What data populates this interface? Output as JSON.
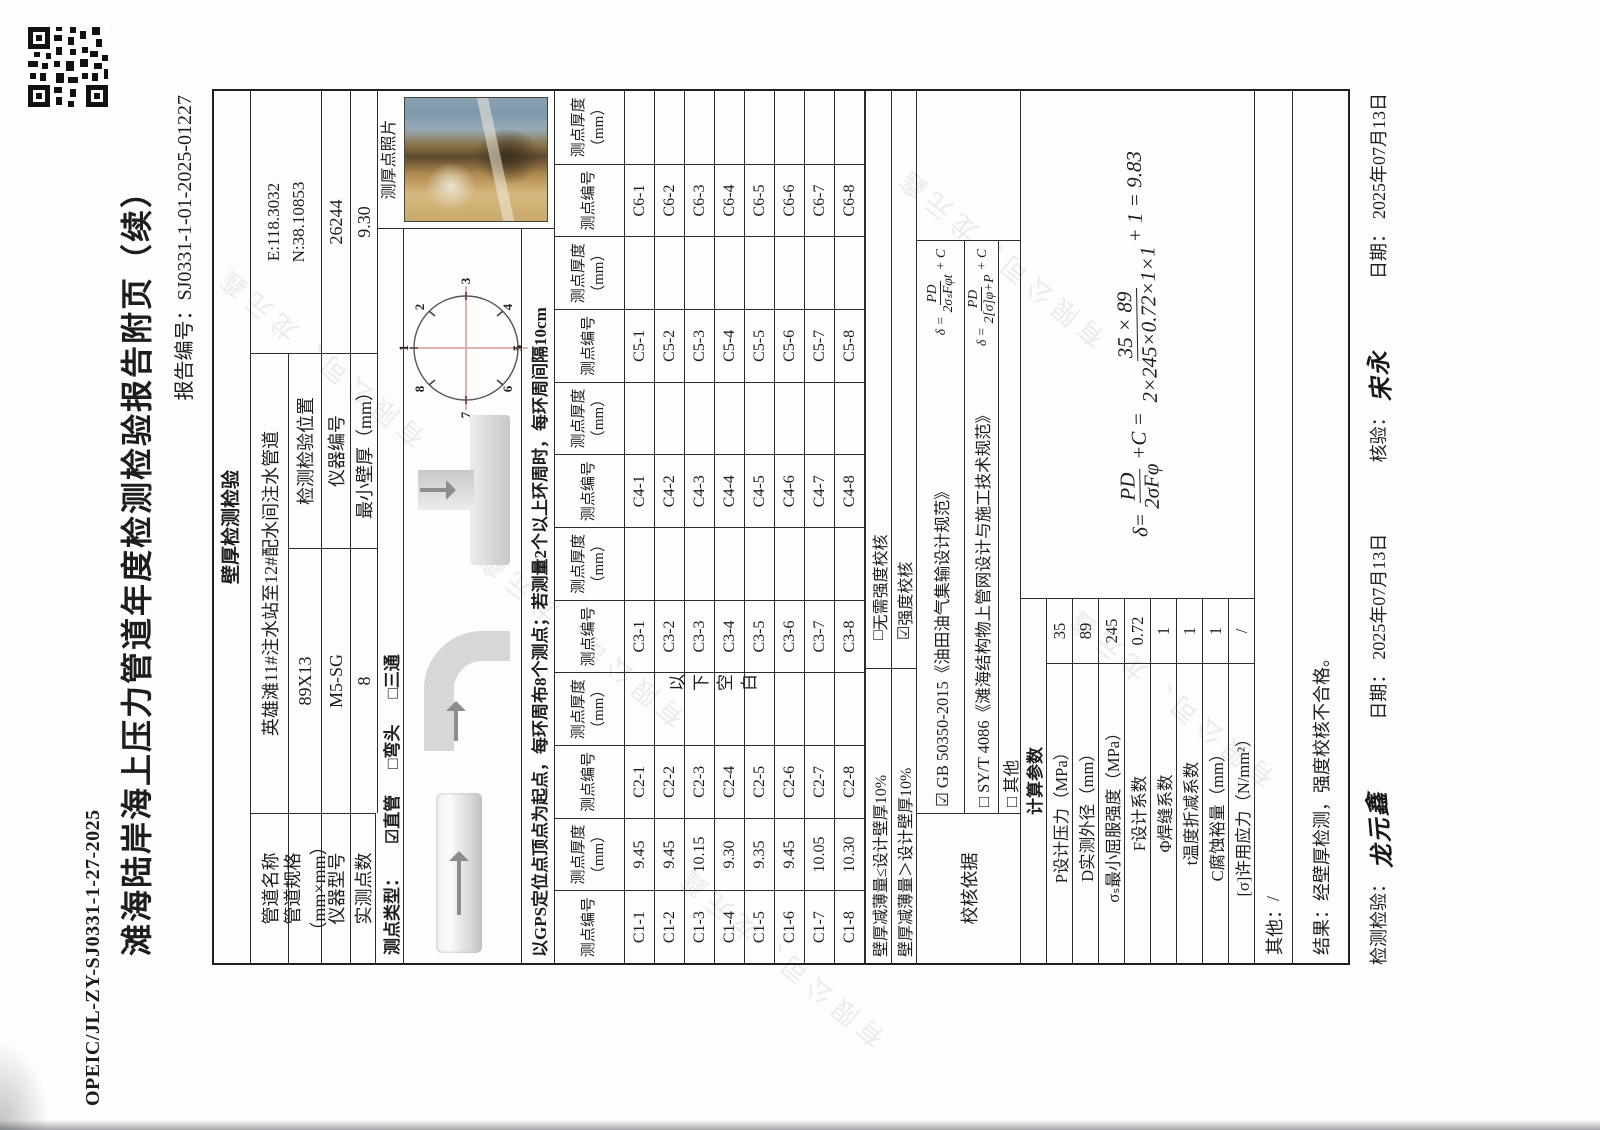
{
  "doc": {
    "code": "OPEIC/JL-ZY-SJ0331-1-27-2025",
    "title": "滩海陆岸海上压力管道年度检测检验报告附页（续）",
    "report_no_label": "报告编号：",
    "report_no": "SJ0331-1-01-2025-01227"
  },
  "section_title": "壁厚检测检验",
  "info": {
    "pipe_name_label": "管道名称",
    "pipe_name": "英雄滩11#注水站至12#配水间注水管道",
    "location_label": "检测检验位置",
    "location_e": "E:118.3032",
    "location_n": "N:38.10853",
    "spec_label": "管道规格（mm×mm）",
    "spec": "89X13",
    "instr_model_label": "仪器型号",
    "instr_model": "M5-SG",
    "instr_no_label": "仪器编号",
    "instr_no": "26244",
    "points_label": "实测点数",
    "points": "8",
    "min_thickness_label": "最小壁厚（mm）",
    "min_thickness": "9.30",
    "type_label": "测点类型：",
    "type_options": [
      {
        "mark": "☑",
        "label": "直管"
      },
      {
        "mark": "□",
        "label": "弯头"
      },
      {
        "mark": "□",
        "label": "三通"
      }
    ],
    "photo_label": "测厚点照片"
  },
  "gps_note": "以GPS定位点顶点为起点，每环周布8个测点；若测量2个以上环周时，每环周间隔10cm",
  "circle_points": [
    "1",
    "2",
    "3",
    "4",
    "5",
    "6",
    "7",
    "8"
  ],
  "grid": {
    "id_header": "测点编号",
    "th_header": "测点厚度（mm）",
    "blank_note": "以下空白",
    "groups": [
      {
        "name": "C1",
        "ids": [
          "C1-1",
          "C1-2",
          "C1-3",
          "C1-4",
          "C1-5",
          "C1-6",
          "C1-7",
          "C1-8"
        ],
        "values": [
          "9.45",
          "9.45",
          "10.15",
          "9.30",
          "9.35",
          "9.45",
          "10.05",
          "10.30"
        ]
      },
      {
        "name": "C2",
        "ids": [
          "C2-1",
          "C2-2",
          "C2-3",
          "C2-4",
          "C2-5",
          "C2-6",
          "C2-7",
          "C2-8"
        ],
        "values": [
          "",
          "",
          "",
          "",
          "",
          "",
          "",
          ""
        ]
      },
      {
        "name": "C3",
        "ids": [
          "C3-1",
          "C3-2",
          "C3-3",
          "C3-4",
          "C3-5",
          "C3-6",
          "C3-7",
          "C3-8"
        ],
        "values": [
          "",
          "",
          "",
          "",
          "",
          "",
          "",
          ""
        ]
      },
      {
        "name": "C4",
        "ids": [
          "C4-1",
          "C4-2",
          "C4-3",
          "C4-4",
          "C4-5",
          "C4-6",
          "C4-7",
          "C4-8"
        ],
        "values": [
          "",
          "",
          "",
          "",
          "",
          "",
          "",
          ""
        ]
      },
      {
        "name": "C5",
        "ids": [
          "C5-1",
          "C5-2",
          "C5-3",
          "C5-4",
          "C5-5",
          "C5-6",
          "C5-7",
          "C5-8"
        ],
        "values": [
          "",
          "",
          "",
          "",
          "",
          "",
          "",
          ""
        ]
      },
      {
        "name": "C6",
        "ids": [
          "C6-1",
          "C6-2",
          "C6-3",
          "C6-4",
          "C6-5",
          "C6-6",
          "C6-7",
          "C6-8"
        ],
        "values": [
          "",
          "",
          "",
          "",
          "",
          "",
          "",
          ""
        ]
      }
    ]
  },
  "check": {
    "row1_label": "壁厚减薄量≤设计壁厚10%",
    "row1_mark": "□",
    "row1_option": "无需强度校核",
    "row2_label": "壁厚减薄量＞设计壁厚10%",
    "row2_mark": "☑",
    "row2_option": "强度校核"
  },
  "basis": {
    "label": "校核依据",
    "items": [
      {
        "mark": "☑",
        "text": "GB 50350-2015《油田油气集输设计规范》"
      },
      {
        "mark": "□",
        "text": "SY/T 4086《滩海结构物上管网设计与施工技术规范》"
      },
      {
        "mark": "□",
        "text": "其他"
      }
    ],
    "formula1": {
      "lead": "δ =",
      "num": "PD",
      "den": "2σₛFφt",
      "tail": "+ C"
    },
    "formula2": {
      "lead": "δ =",
      "num": "PD",
      "den": "2[σ]φ+P",
      "tail": "+ C"
    }
  },
  "params": {
    "header": "计算参数",
    "rows": [
      {
        "label": "P设计压力（MPa）",
        "value": "35"
      },
      {
        "label": "D实测外径（mm）",
        "value": "89"
      },
      {
        "label": "σₛ最小屈服强度（MPa）",
        "value": "245"
      },
      {
        "label": "F设计系数",
        "value": "0.72"
      },
      {
        "label": "Φ焊缝系数",
        "value": "1"
      },
      {
        "label": "t温度折减系数",
        "value": "1"
      },
      {
        "label": "C腐蚀裕量（mm）",
        "value": "1"
      },
      {
        "label": "[σ]许用应力（N/mm²）",
        "value": "/"
      }
    ],
    "calc": {
      "lead": "δ=",
      "f_num": "PD",
      "f_den": "2σFφ",
      "mid": "+C =",
      "num": "35 × 89",
      "den": "2×245×0.72×1×1",
      "tail": "+ 1 = 9.83"
    }
  },
  "other": {
    "label": "其他：",
    "value": "/"
  },
  "result": {
    "label": "结果：",
    "value": "经壁厚检测，强度校核不合格。"
  },
  "footer": {
    "inspector_label": "检测检验：",
    "inspector_sig": "龙元鑫",
    "date1_label": "日期：",
    "date1": "2025年07月13日",
    "checker_label": "核验：",
    "checker_sig": "宋永",
    "date2_label": "日期：",
    "date2": "2025年07月13日"
  },
  "watermark": "有限公司、龙元鑫"
}
